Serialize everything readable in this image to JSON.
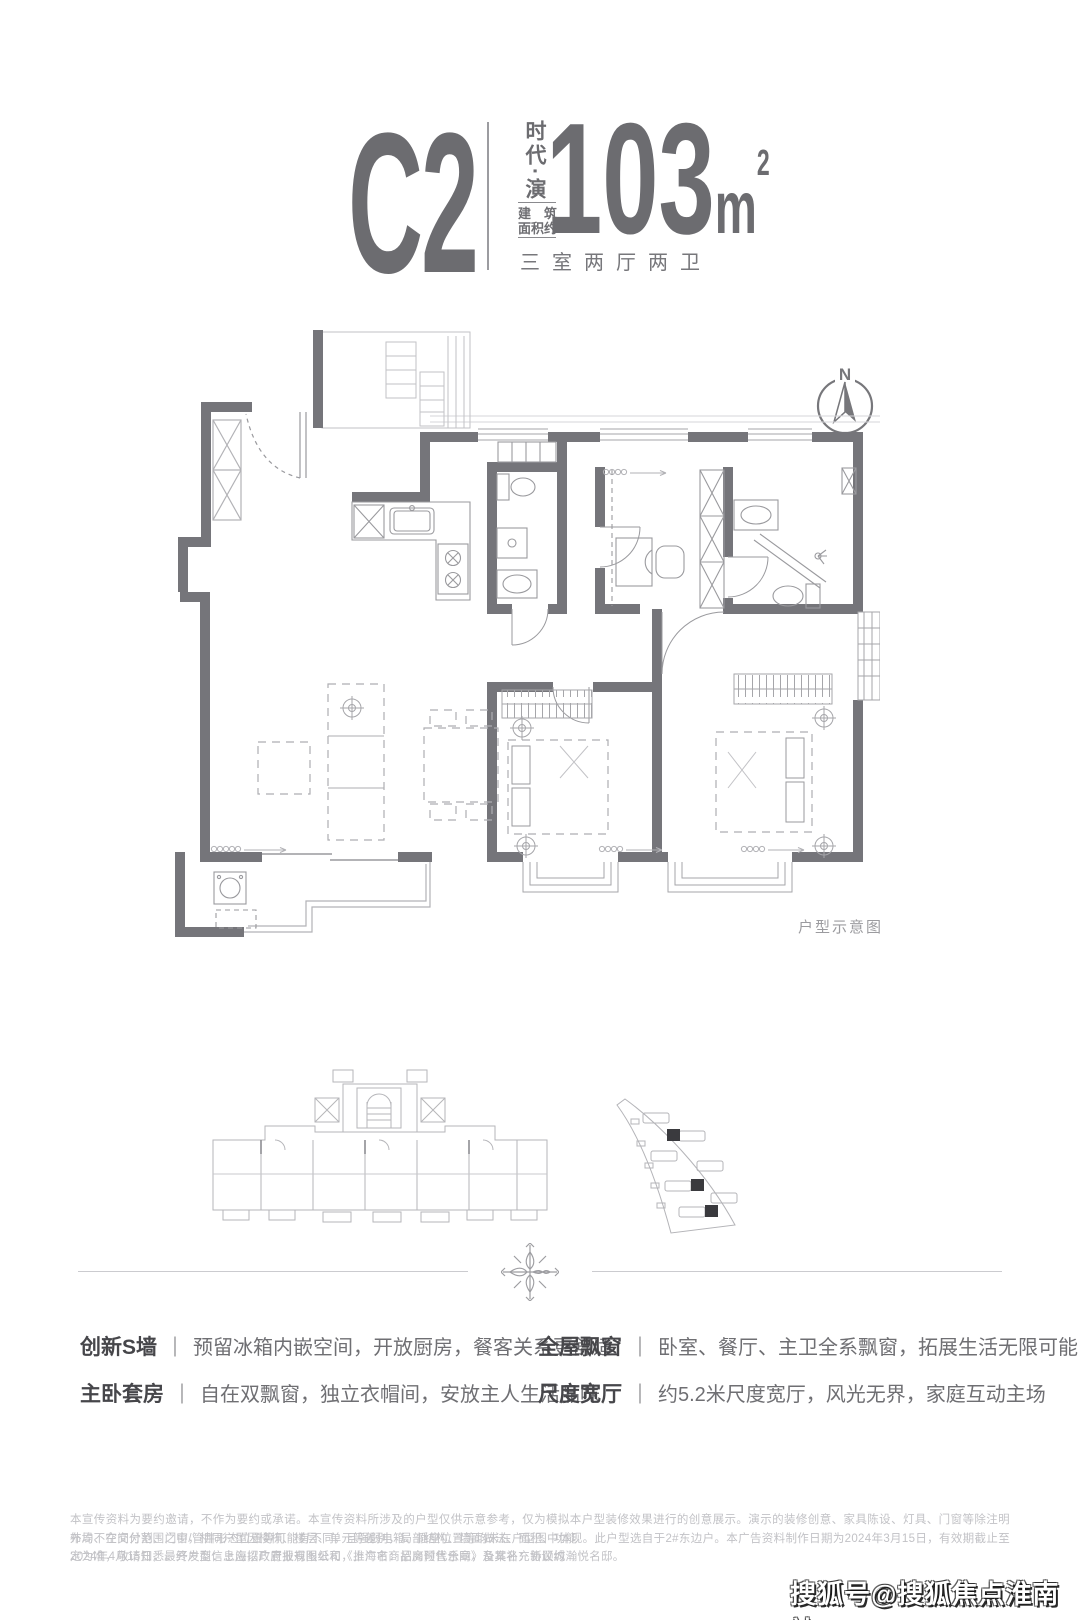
{
  "header": {
    "unit_code": "C2",
    "series_name_vertical": "时代·演",
    "area_label_line1": "建　筑",
    "area_label_line2": "面积约",
    "area_value": "103",
    "area_unit": "m",
    "area_exponent": "2",
    "rooms_summary": "三室两厅两卫"
  },
  "floorplan": {
    "compass_label": "N",
    "caption": "户型示意图"
  },
  "features": {
    "left": [
      {
        "label": "创新S墙",
        "divider": "｜",
        "text": "预留冰箱内嵌空间，开放厨房，餐客关系更舒适"
      },
      {
        "label": "主卧套房",
        "divider": "｜",
        "text": "自在双飘窗，独立衣帽间，安放主人生活品味"
      }
    ],
    "right": [
      {
        "label": "全屋飘窗",
        "divider": "｜",
        "text": "卧室、餐厅、主卫全系飘窗，拓展生活无限可能"
      },
      {
        "label": "尺度宽厅",
        "divider": "｜",
        "text": "约5.2米尺度宽厅，风光无界，家庭互动主场"
      }
    ]
  },
  "disclaimer": {
    "line1": "本宣传资料为要约邀请，不作为要约或承诺。本宣传资料所涉及的户型仅供示意参考，仅为模拟本户型装修效果进行的创意展示。演示的装修创意、家具陈设、灯具、门窗等除注明外均不在交付范围之中，相同户型因楼栋、楼层、单元等差别，局部结构、墙面做法、面积、功能",
    "line2": "布局、空间分割、门窗/管井形态位置等可能有不同，且强弱电箱、插座位置等均未在户型图中体现。此户型选自于2#东边户。本广告资料制作日期为2024年3月15日，有效期截止至2024年4月15日，最终户型信息应以政府报规图纸和《上海市商品房预售合同》及其补充协议约",
    "line3": "定为准，敬请知悉。开发商：上海招广置业有限公司，推广名：招商时代乐章，备案名：新顾城瀚悦名邸。"
  },
  "watermark": "搜狐号@搜狐焦点淮南站",
  "colors": {
    "wall": "#75757a",
    "thin_line": "#a4a4a8",
    "light_line": "#c6c6ca",
    "text_dark": "#46464a",
    "text_mid": "#6f6f73",
    "text_faint": "#c2c2c6"
  }
}
